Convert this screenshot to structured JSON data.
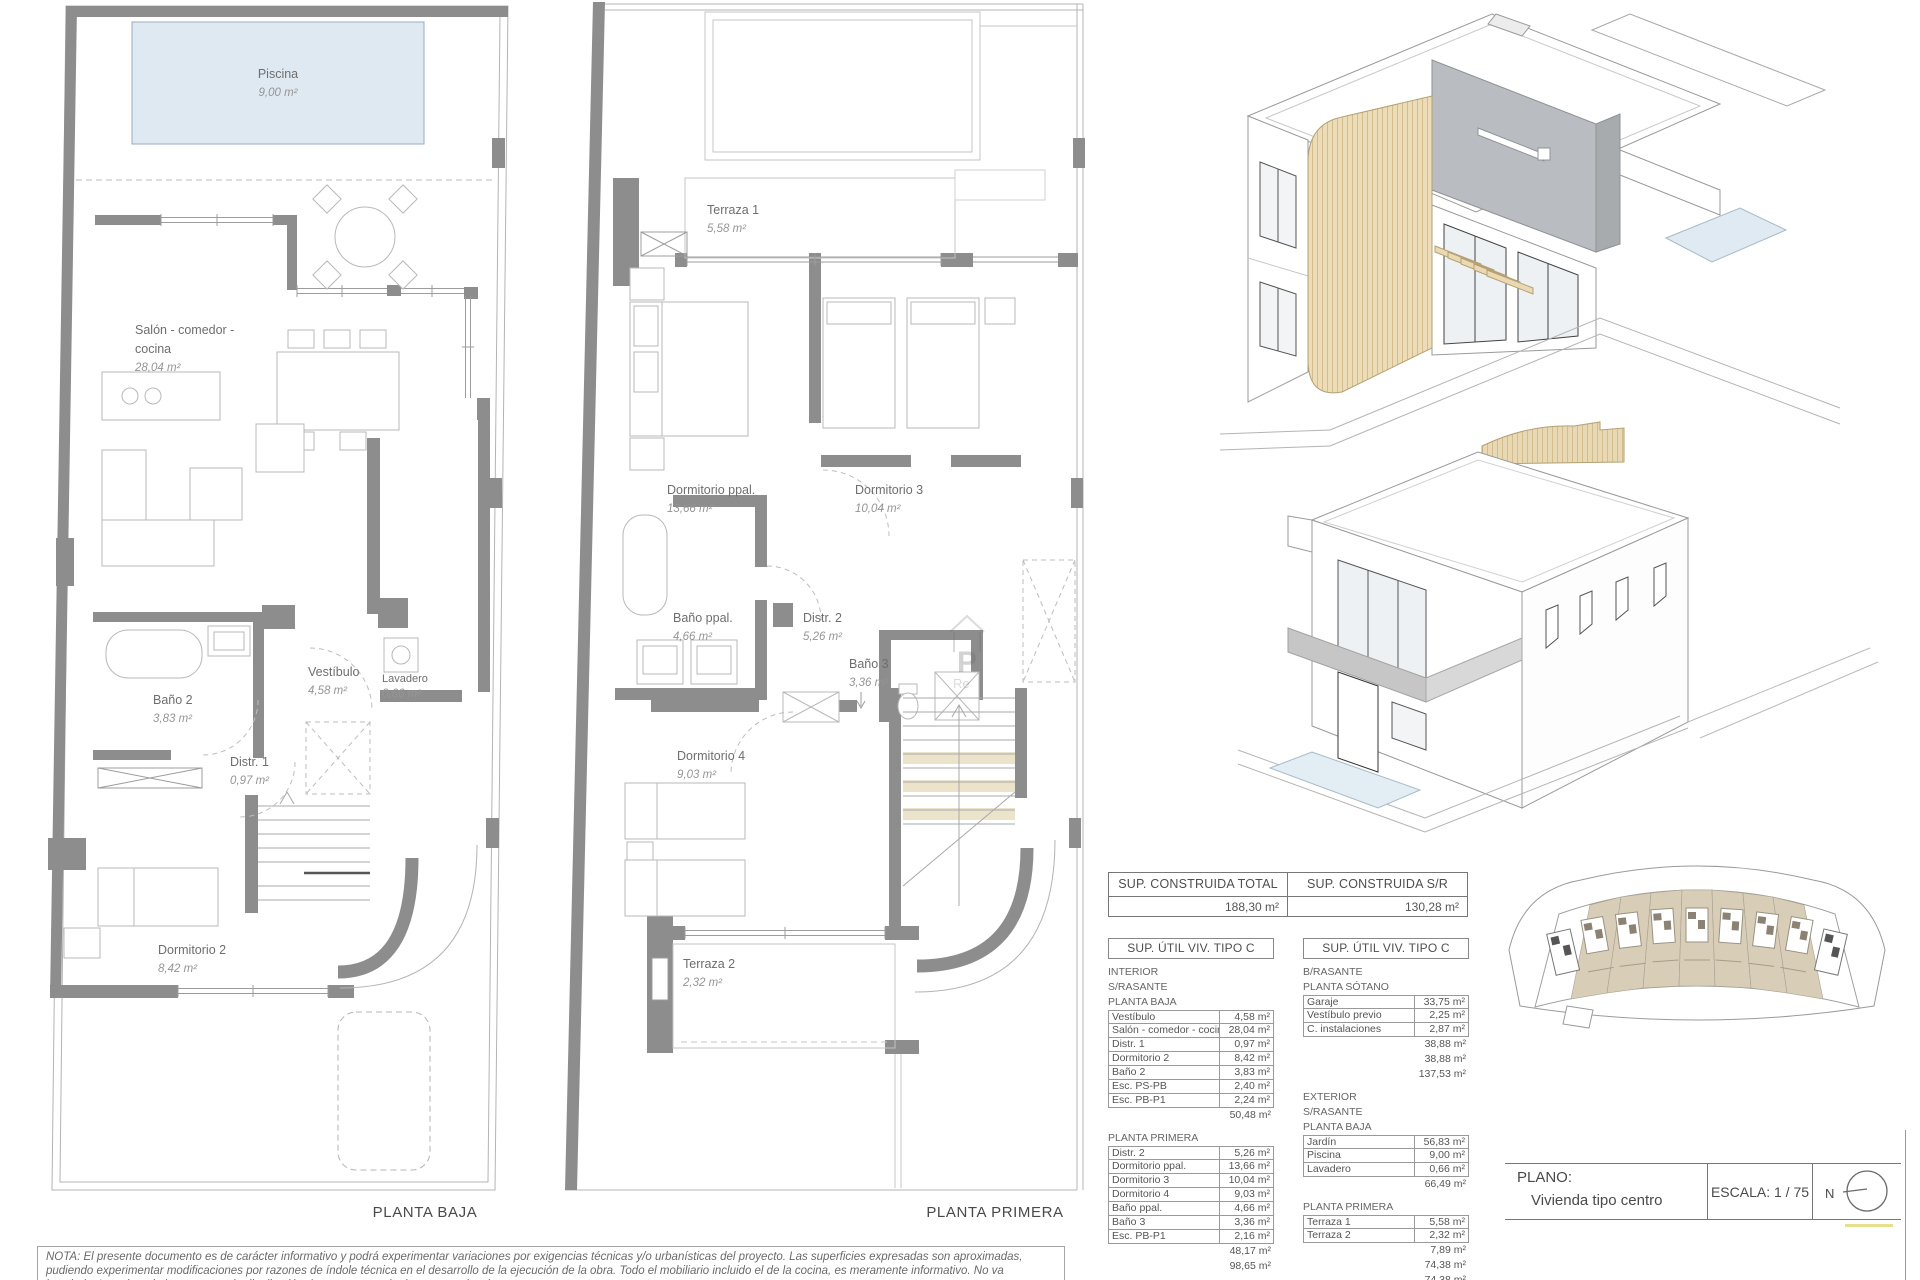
{
  "sheet": {
    "nota": "NOTA: El presente documento es de carácter informativo y podrá experimentar variaciones por exigencias técnicas y/o urbanísticas del proyecto. Las superficies expresadas son aproximadas, pudiendo experimentar modificaciones por razones de índole técnica en el desarrollo de la ejecución de la obra. Todo el mobiliario incluido el de la cocina, es meramente informativo. No va instalada. Los giros de las puertas y la distribución de aparatos sanitarios no son vinculantes.",
    "watermark": {
      "line1": "P",
      "line2": "Re"
    }
  },
  "plans": {
    "baja": {
      "title": "PLANTA BAJA",
      "rooms": [
        {
          "name": "Piscina",
          "area": "9,00 m²"
        },
        {
          "name": "Salón - comedor -",
          "name2": "cocina",
          "area": "28,04 m²"
        },
        {
          "name": "Vestíbulo",
          "area": "4,58 m²"
        },
        {
          "name": "Lavadero",
          "area": "0,66 m²"
        },
        {
          "name": "Baño 2",
          "area": "3,83 m²"
        },
        {
          "name": "Distr. 1",
          "area": "0,97 m²"
        },
        {
          "name": "Dormitorio 2",
          "area": "8,42 m²"
        }
      ]
    },
    "primera": {
      "title": "PLANTA PRIMERA",
      "rooms": [
        {
          "name": "Terraza 1",
          "area": "5,58 m²"
        },
        {
          "name": "Dormitorio ppal.",
          "area": "13,66 m²"
        },
        {
          "name": "Dormitorio 3",
          "area": "10,04 m²"
        },
        {
          "name": "Baño ppal.",
          "area": "4,66 m²"
        },
        {
          "name": "Distr. 2",
          "area": "5,26 m²"
        },
        {
          "name": "Baño 3",
          "area": "3,36 m²"
        },
        {
          "name": "Dormitorio 4",
          "area": "9,03 m²"
        },
        {
          "name": "Terraza 2",
          "area": "2,32 m²"
        }
      ]
    }
  },
  "tables": {
    "summary": {
      "cols": [
        {
          "header": "SUP. CONSTRUIDA TOTAL",
          "value": "188,30 m²"
        },
        {
          "header": "SUP. CONSTRUIDA S/R",
          "value": "130,28 m²"
        }
      ]
    },
    "util_left": {
      "header": "SUP. ÚTIL VIV. TIPO C",
      "sections": [
        {
          "labels": [
            "INTERIOR",
            "S/RASANTE",
            "PLANTA BAJA"
          ],
          "rows": [
            [
              "Vestíbulo",
              "4,58 m²"
            ],
            [
              "Salón - comedor - cocina",
              "28,04 m²"
            ],
            [
              "Distr. 1",
              "0,97 m²"
            ],
            [
              "Dormitorio 2",
              "8,42 m²"
            ],
            [
              "Baño 2",
              "3,83 m²"
            ],
            [
              "Esc. PS-PB",
              "2,40 m²"
            ],
            [
              "Esc. PB-P1",
              "2,24 m²"
            ]
          ],
          "totals": [
            "50,48 m²"
          ]
        },
        {
          "labels": [
            "PLANTA PRIMERA"
          ],
          "rows": [
            [
              "Distr. 2",
              "5,26 m²"
            ],
            [
              "Dormitorio ppal.",
              "13,66 m²"
            ],
            [
              "Dormitorio 3",
              "10,04 m²"
            ],
            [
              "Dormitorio 4",
              "9,03 m²"
            ],
            [
              "Baño ppal.",
              "4,66 m²"
            ],
            [
              "Baño 3",
              "3,36 m²"
            ],
            [
              "Esc. PB-P1",
              "2,16 m²"
            ]
          ],
          "totals": [
            "48,17 m²",
            "98,65 m²"
          ]
        }
      ]
    },
    "util_right": {
      "header": "SUP. ÚTIL VIV. TIPO C",
      "sections": [
        {
          "labels": [
            "B/RASANTE",
            "PLANTA SÓTANO"
          ],
          "rows": [
            [
              "Garaje",
              "33,75 m²"
            ],
            [
              "Vestíbulo previo",
              "2,25 m²"
            ],
            [
              "C. instalaciones",
              "2,87 m²"
            ]
          ],
          "totals": [
            "38,88 m²",
            "38,88 m²",
            "137,53 m²"
          ]
        },
        {
          "labels": [
            "EXTERIOR",
            "S/RASANTE",
            "PLANTA BAJA"
          ],
          "rows": [
            [
              "Jardín",
              "56,83 m²"
            ],
            [
              "Piscina",
              "9,00 m²"
            ],
            [
              "Lavadero",
              "0,66 m²"
            ]
          ],
          "totals": [
            "66,49 m²"
          ]
        },
        {
          "labels": [
            "PLANTA PRIMERA"
          ],
          "rows": [
            [
              "Terraza 1",
              "5,58 m²"
            ],
            [
              "Terraza 2",
              "2,32 m²"
            ]
          ],
          "totals": [
            "7,89 m²",
            "74,38 m²",
            "74,38 m²"
          ]
        }
      ]
    }
  },
  "titleblock": {
    "plano_label": "PLANO:",
    "plano_value": "Vivienda tipo centro",
    "escala_label": "ESCALA:",
    "escala_value": "1 / 75",
    "north_label": "N"
  },
  "colors": {
    "wall_gray": "#8d8d8d",
    "pool_fill": "#dfe9f2",
    "wood_tan": "#ead9b4",
    "panel_gray": "#b9bdc1",
    "site_tan": "#d8cdb7",
    "accent_yellow": "#ddd45f"
  }
}
